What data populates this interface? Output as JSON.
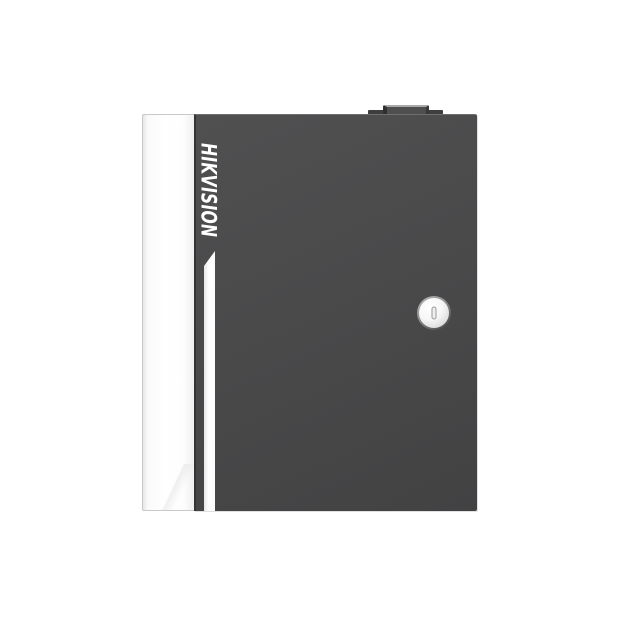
{
  "photo": {
    "background_color": "#ffffff",
    "subject": "Dark gray metal enclosure with white side panel, vertical brand logo, white accent stripe, round key lock and top hinge bump"
  },
  "device": {
    "brand_label": "HIKVISION",
    "colors": {
      "door_gray": "#4a4a4b",
      "door_edge_dark": "#343434",
      "door_top_highlight": "#6f6f6f",
      "side_panel_white": "#fcfcfc",
      "accent_stripe_white": "#fdfdfd",
      "top_bump_gray": "#3e3e3e",
      "top_bump_highlight": "#a9a9a9",
      "lock_ring_gray": "#8a8a8a",
      "lock_face_white": "#f6f6f6",
      "keyhole_outline_gray": "#9a9a9a",
      "brand_text_white": "#ffffff"
    }
  }
}
